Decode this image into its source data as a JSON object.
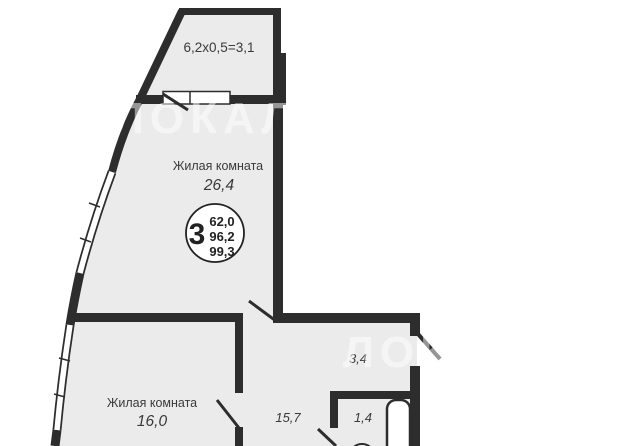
{
  "watermark": {
    "text": "ЛОКАЛС"
  },
  "colors": {
    "wall": "#2d2d2d",
    "floor": "#ebebeb",
    "label_text": "#3a3a3a",
    "watermark": "#ffffff"
  },
  "plan": {
    "balcony_label": "6,2x0,5=3,1",
    "living_room_1": {
      "name": "Жилая комната",
      "area": "26,4"
    },
    "living_room_2": {
      "name": "Жилая комната",
      "area": "16,0"
    },
    "hallway_area": "15,7",
    "entry_area": "3,4",
    "bathroom_area": "1,4",
    "info_badge": {
      "room_count": "3",
      "areas": [
        "62,0",
        "96,2",
        "99,3"
      ]
    }
  }
}
